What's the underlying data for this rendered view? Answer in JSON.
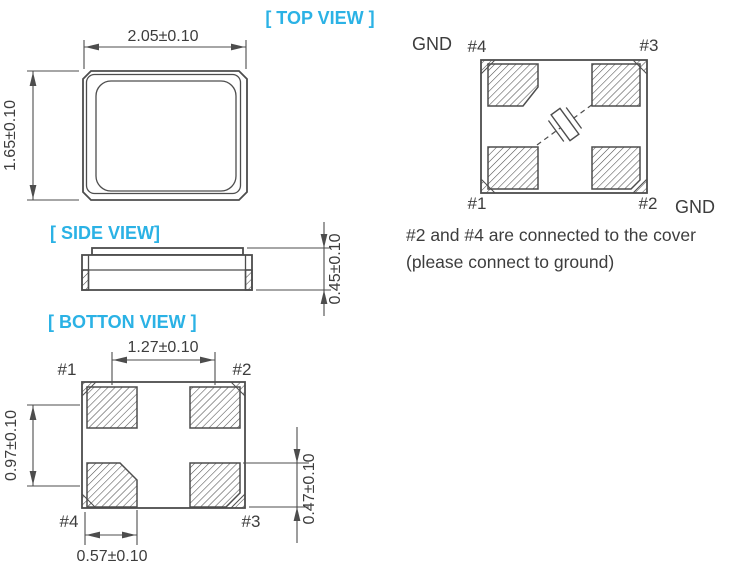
{
  "colors": {
    "accent": "#2bb2e5",
    "line": "#4d4d4d",
    "text": "#3d3d3d",
    "background": "#ffffff"
  },
  "top_view": {
    "title": "[ TOP VIEW ]",
    "width_dim": "2.05±0.10",
    "height_dim": "1.65±0.10"
  },
  "side_view": {
    "title": "[ SIDE VIEW]",
    "height_dim": "0.45±0.10"
  },
  "bottom_view": {
    "title": "[ BOTTON VIEW ]",
    "pitch_x_dim": "1.27±0.10",
    "pitch_y_dim": "0.97±0.10",
    "pad_height_dim": "0.47±0.10",
    "pad_width_dim": "0.57±0.10",
    "pins": {
      "top_left": "#1",
      "top_right": "#2",
      "bottom_left": "#4",
      "bottom_right": "#3"
    }
  },
  "pin_layout": {
    "gnd_top": "GND",
    "gnd_bottom": "GND",
    "pins": {
      "top_left": "#4",
      "top_right": "#3",
      "bottom_left": "#1",
      "bottom_right": "#2"
    }
  },
  "note": {
    "line1": "#2 and #4 are connected to the cover",
    "line2": "(please connect to ground)"
  }
}
